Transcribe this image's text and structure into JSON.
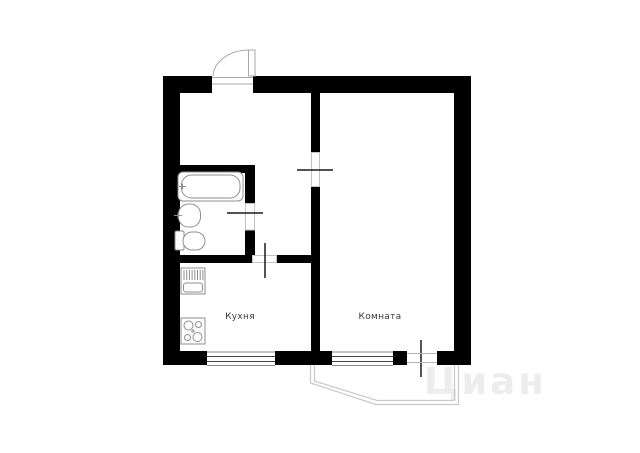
{
  "floorplan": {
    "labels": {
      "kitchen": "Кухня",
      "room": "Комната"
    },
    "watermark": "Циан",
    "colors": {
      "wall": "#000000",
      "fixture_stroke": "#8f8f8f",
      "door_symbol": "#1a1a1a",
      "window_frame": "#444444",
      "window_edge": "#8a8a8a",
      "balcony_outline": "#c9c9c9",
      "door_swing": "#aaaaaa",
      "label_text": "#3a3a3a",
      "watermark_text": "#ededed",
      "background": "#ffffff"
    }
  }
}
